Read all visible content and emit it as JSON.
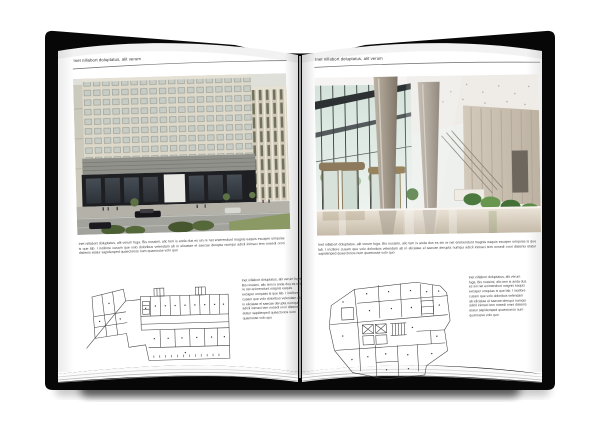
{
  "document_type": "open-book-brochure-spread",
  "colors": {
    "background": "#ffffff",
    "cover": "#0a0a0a",
    "page": "#ffffff",
    "rule": "#6e6e6e",
    "body_text": "#3d3d3d"
  },
  "left_page": {
    "header": "Inet nillabort doluptatus, alit verum",
    "photo_subject": "building-exterior-street-view",
    "caption": "Inet nillabort doluptatus, alit verum fuga. Bis nossimi, alic tem is anda dus es sin re net enimendunt magnis eaquis excaper umquias is que lab. I incillore cusam que volo doloribus velendam ab in eliciatae el saecae derupta numqui adicil inimaci tem nosedi orori distenis etatur sapidenped quaectorios num quamusse volo quo",
    "plan_subject": "floor-plan-drawing",
    "side_text": "Inet nillabort doluptatus, alit verum fuga. Bis nossimi, alic tem is anda dus es sin re net enimendunt magnis eaquis excaper umquias is que lab. I incillore cusam que volo doloribus velendam ab in eliciatae el saecae derupta numqui adicil inimaci tem nosedi orori distenis etatur sapidenped quaectorios num quamusse volo quo"
  },
  "right_page": {
    "header": "Inet nillabort doluptatus, alit verum",
    "photo_subject": "lobby-interior-view",
    "caption": "Inet nillabort doluptatus, alit verum fuga. Bis nossimi, alic tem is anda dus es sin re net enimendunt magnis eaquis excaper umquias is que lab. I incillore cusam que volo doloribus velendam ab in eliciatae el saecae derupta numqui adicil inimaci tem nosedi orori distenis etatur sapidenped quaectorios num quamusse volo quo",
    "plan_subject": "floor-plan-drawing",
    "side_text": "Inet nillabort doluptatus, alit verum fuga. Bis nossimi, alic tem is anda dus es sin net enimendunt magnis eaquis excaper umquias is que lab. I incillore cusam que volo doloribus velendam ab eliciatae el saecae iderupa numqui adicil inimaci tem nosedi omni distenis etatur sapidemped quaectorios num quamusse volo quo"
  }
}
